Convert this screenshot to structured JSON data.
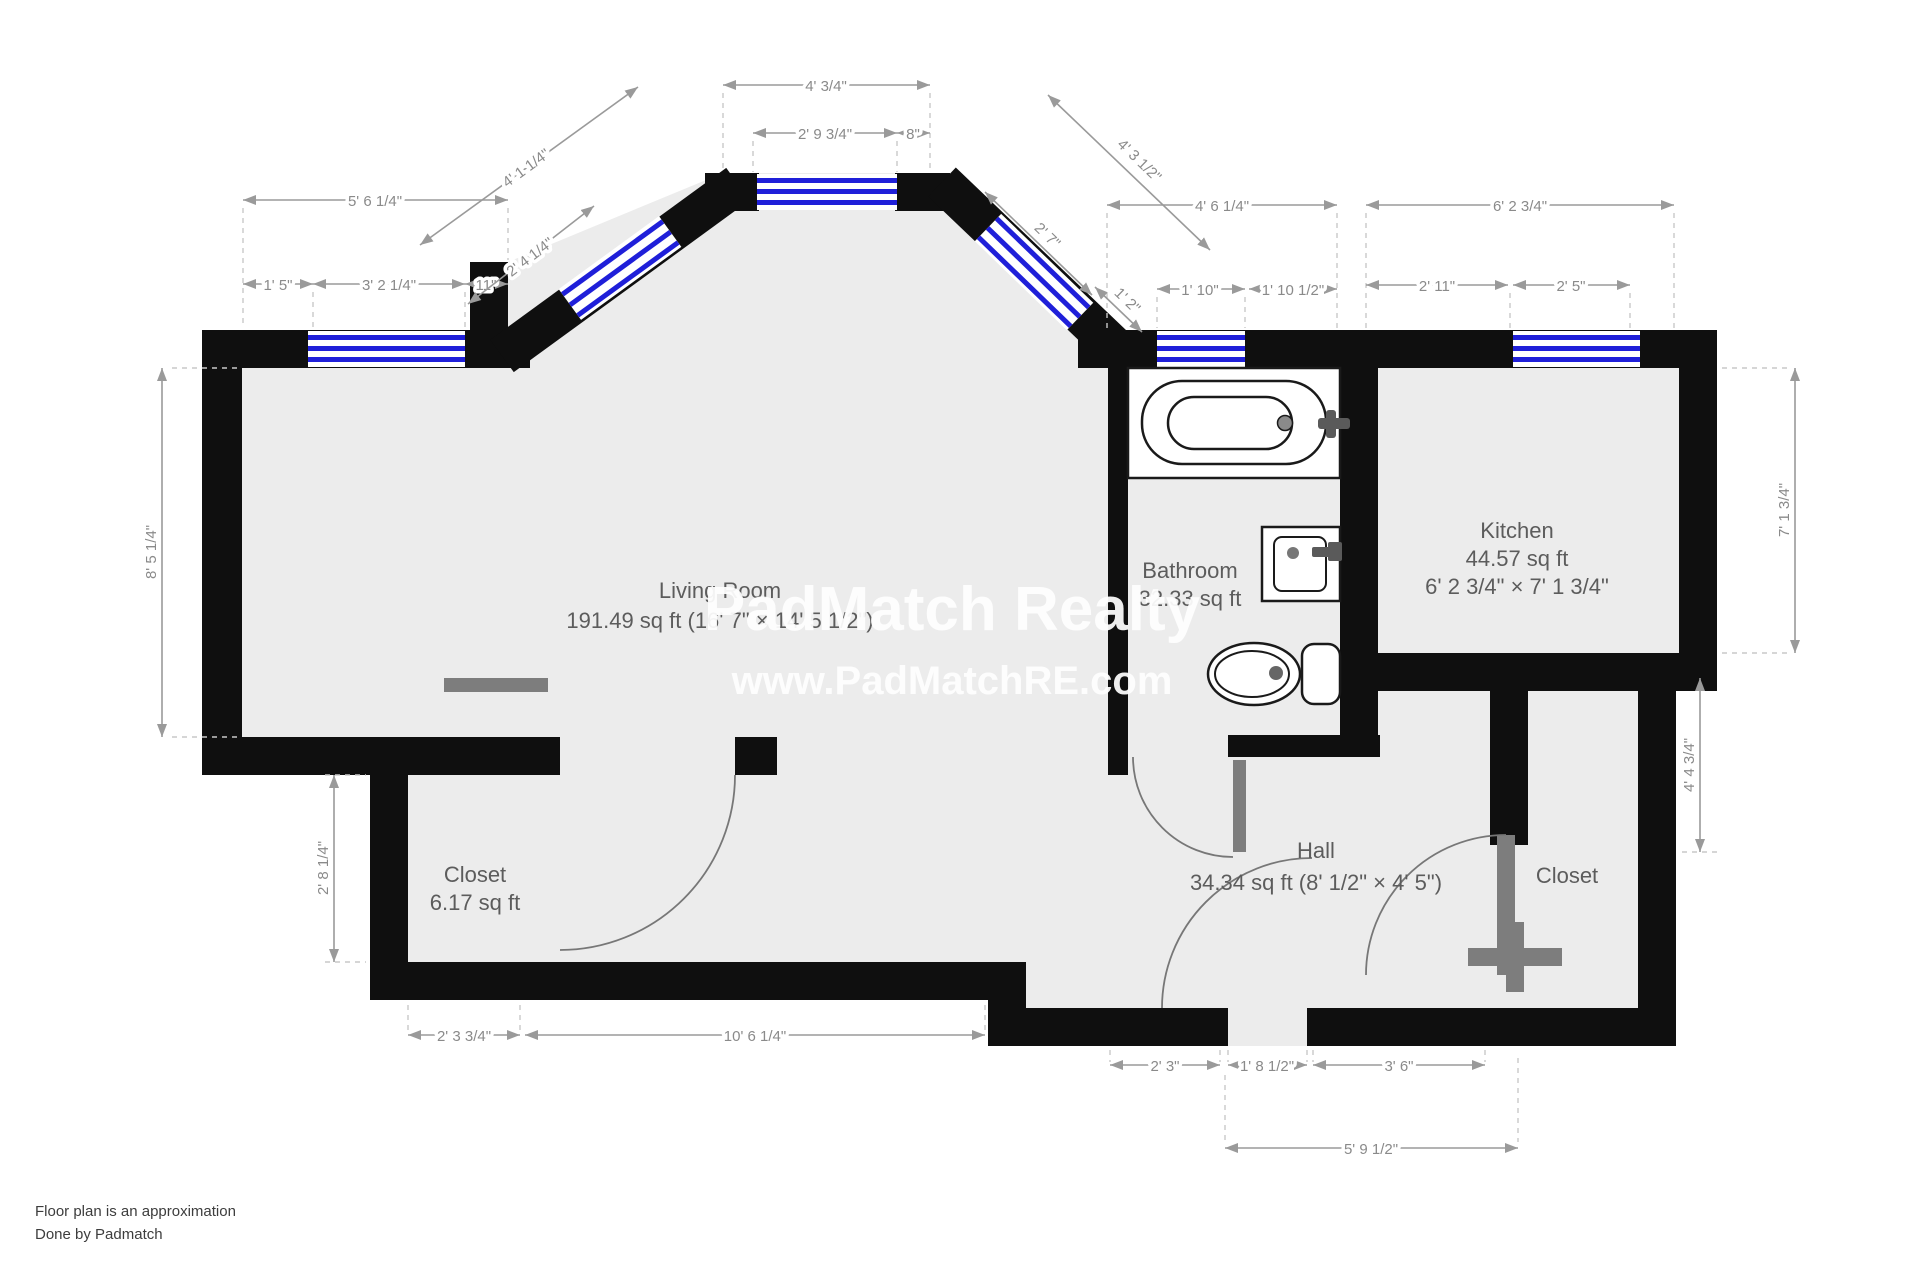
{
  "watermark": {
    "line1": "PadMatch Realty",
    "line2": "www.PadMatchRE.com"
  },
  "footer": {
    "line1": "Floor plan is an approximation",
    "line2": "Done by Padmatch"
  },
  "rooms": {
    "living": {
      "name": "Living Room",
      "area": "191.49 sq ft (16' 7\" × 14' 5 1/2\")"
    },
    "bathroom": {
      "name": "Bathroom",
      "area": "32.33 sq ft"
    },
    "kitchen": {
      "name": "Kitchen",
      "area": "44.57 sq ft",
      "size": "6' 2 3/4\" × 7' 1 3/4\""
    },
    "closet_left": {
      "name": "Closet",
      "area": "6.17 sq ft"
    },
    "hall": {
      "name": "Hall",
      "area": "34.34 sq ft (8' 1/2\" × 4' 5\")"
    },
    "closet_right": {
      "name": "Closet"
    }
  },
  "dims": {
    "top_left_total": "5' 6 1/4\"",
    "top_left_a": "1' 5\"",
    "top_left_window": "3' 2 1/4\"",
    "top_left_c": "11\"",
    "diag_left_total": "4' 1 1/4\"",
    "diag_left_window": "2' 4 1/4\"",
    "top_center_total": "4' 3/4\"",
    "top_center_window": "2' 9 3/4\"",
    "top_center_b": "8\"",
    "diag_right_total": "4' 3 1/2\"",
    "diag_right_window": "2' 7\"",
    "diag_right_b": "1' 2\"",
    "bath_top_total": "4' 6 1/4\"",
    "bath_window": "1' 10\"",
    "bath_top_b": "1' 10 1/2\"",
    "kitchen_top_total": "6' 2 3/4\"",
    "kitchen_top_a": "2' 11\"",
    "kitchen_window": "2' 5\"",
    "left_height": "8' 5 1/4\"",
    "closet_left_height": "2' 8 1/4\"",
    "kitchen_height": "7' 1 3/4\"",
    "closet_right_height": "4' 4 3/4\"",
    "bottom_closet": "2' 3 3/4\"",
    "bottom_living": "10' 6 1/4\"",
    "hall_bottom_a": "2' 3\"",
    "hall_bottom_b": "1' 8 1/2\"",
    "hall_bottom_c": "3' 6\"",
    "hall_bottom_total": "5' 9 1/2\""
  },
  "colors": {
    "wall": "#0f0f0f",
    "floor": "#ececec",
    "window_blue": "#1f1fd9"
  }
}
